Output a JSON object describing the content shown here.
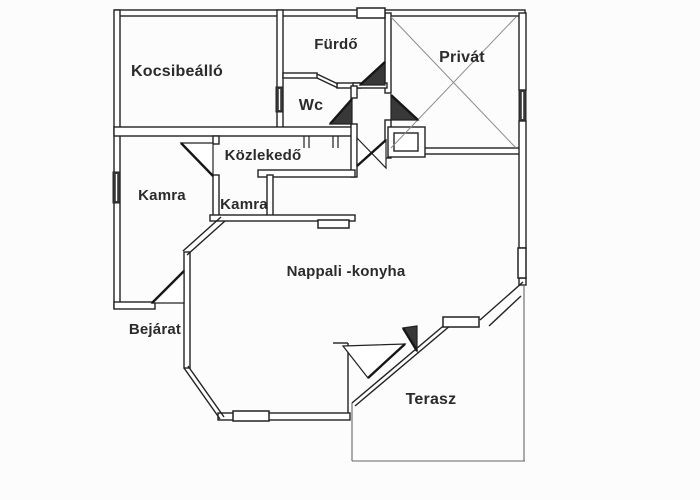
{
  "canvas": {
    "width": 700,
    "height": 500,
    "background": "#fcfcfc",
    "wall_fill": "#ffffff",
    "wall_stroke": "#222222",
    "dark_fill": "#383838",
    "thin_color": "#666666",
    "diag_color": "#8c8c8c",
    "text_color": "#2b2b2b"
  },
  "plan": {
    "labels": [
      {
        "id": "kocsibeallo",
        "text": "Kocsibeálló",
        "x": 177,
        "y": 72,
        "size": 16
      },
      {
        "id": "furdo",
        "text": "Fürdő",
        "x": 336,
        "y": 45,
        "size": 15
      },
      {
        "id": "wc",
        "text": "Wc",
        "x": 311,
        "y": 106,
        "size": 16
      },
      {
        "id": "privat",
        "text": "Privát",
        "x": 462,
        "y": 58,
        "size": 16
      },
      {
        "id": "kamra-nagy",
        "text": "Kamra",
        "x": 162,
        "y": 196,
        "size": 15
      },
      {
        "id": "kozlekedo",
        "text": "Közlekedő",
        "x": 263,
        "y": 156,
        "size": 15
      },
      {
        "id": "kamra-kicsi",
        "text": "Kamra",
        "x": 244,
        "y": 205,
        "size": 15
      },
      {
        "id": "nappali",
        "text": "Nappali -konyha",
        "x": 346,
        "y": 272,
        "size": 15
      },
      {
        "id": "bejarat",
        "text": "Bejárat",
        "x": 155,
        "y": 330,
        "size": 15
      },
      {
        "id": "terasz",
        "text": "Terasz",
        "x": 431,
        "y": 400,
        "size": 16
      }
    ],
    "walls": [
      {
        "n": "top-wall",
        "r": [
          115,
          10,
          410,
          6
        ]
      },
      {
        "n": "left-wall",
        "r": [
          114,
          10,
          6,
          298
        ]
      },
      {
        "n": "carport-right-wall",
        "r": [
          277,
          10,
          6,
          122
        ]
      },
      {
        "n": "main-horizontal-wall",
        "r": [
          114,
          127,
          242,
          9
        ]
      },
      {
        "n": "bath-private-wall",
        "r": [
          385,
          13,
          6,
          80
        ]
      },
      {
        "n": "private-left-wall",
        "r": [
          385,
          120,
          6,
          38
        ]
      },
      {
        "n": "private-bottom-wall",
        "r": [
          423,
          148,
          98,
          6
        ]
      },
      {
        "n": "right-wall-top",
        "r": [
          519,
          13,
          7,
          77
        ]
      },
      {
        "n": "right-wall-mid",
        "r": [
          519,
          121,
          7,
          127
        ]
      },
      {
        "n": "right-wall-stub",
        "r": [
          519,
          278,
          7,
          7
        ]
      },
      {
        "n": "bath-bottom-wall-a",
        "r": [
          283,
          73,
          34,
          5
        ]
      },
      {
        "n": "bath-bottom-wall-b",
        "r": [
          337,
          83,
          24,
          5
        ]
      },
      {
        "n": "hall-top-wall",
        "r": [
          353,
          83,
          34,
          5
        ]
      },
      {
        "n": "wc-right-wall-a",
        "r": [
          351,
          86,
          6,
          12
        ]
      },
      {
        "n": "wc-right-wall-b",
        "r": [
          351,
          124,
          6,
          53
        ]
      },
      {
        "n": "hallway-bottom-wall",
        "r": [
          258,
          170,
          97,
          7
        ]
      },
      {
        "n": "pantry2-left-wall-stub",
        "r": [
          213,
          136,
          6,
          8
        ]
      },
      {
        "n": "pantry2-left-wall",
        "r": [
          213,
          175,
          6,
          41
        ]
      },
      {
        "n": "closet-divider-wall",
        "r": [
          267,
          175,
          6,
          41
        ]
      },
      {
        "n": "closet-bottom-wall",
        "r": [
          210,
          215,
          145,
          6
        ]
      },
      {
        "n": "living-left-wall",
        "r": [
          184,
          252,
          6,
          116
        ]
      },
      {
        "n": "pantry-bottom-wall",
        "r": [
          114,
          302,
          41,
          7
        ]
      },
      {
        "n": "living-bottom-wall",
        "r": [
          218,
          413,
          132,
          7
        ]
      },
      {
        "n": "private-nook-outer",
        "r": [
          388,
          127,
          37,
          30
        ]
      },
      {
        "n": "private-nook-inner",
        "r": [
          394,
          133,
          24,
          18
        ]
      }
    ],
    "lines": [
      {
        "n": "bay-upper-chamfer-outer",
        "p": [
          183,
          251,
          221,
          217
        ],
        "w": 1.4
      },
      {
        "n": "bay-upper-chamfer-inner",
        "p": [
          187,
          255,
          225,
          221
        ],
        "w": 1.4
      },
      {
        "n": "bay-lower-chamfer-outer",
        "p": [
          184,
          368,
          220,
          419
        ],
        "w": 1.4
      },
      {
        "n": "bay-lower-chamfer-inner",
        "p": [
          188,
          366,
          224,
          417
        ],
        "w": 1.4
      },
      {
        "n": "terrace-diagonal-outer",
        "p": [
          352,
          403,
          448,
          322
        ],
        "w": 1.4
      },
      {
        "n": "terrace-diagonal-inner",
        "p": [
          355,
          406,
          451,
          325
        ],
        "w": 1.4
      },
      {
        "n": "terrace-ne-chamfer-outer",
        "p": [
          480,
          320,
          523,
          282
        ],
        "w": 1.4
      },
      {
        "n": "terrace-ne-chamfer-inner",
        "p": [
          489,
          326,
          521,
          296
        ],
        "w": 1.4
      },
      {
        "n": "kitchen-step-h",
        "p": [
          333,
          343,
          348,
          343
        ],
        "w": 1.4
      },
      {
        "n": "kitchen-step-v",
        "p": [
          348,
          343,
          348,
          413
        ],
        "w": 1.4
      },
      {
        "n": "bath-step-diag-a",
        "p": [
          317,
          74,
          338,
          84
        ],
        "w": 1.3
      },
      {
        "n": "bath-step-diag-b",
        "p": [
          317,
          78,
          338,
          88
        ],
        "w": 1.3
      },
      {
        "n": "terrace-edge-left",
        "p": [
          352,
          403,
          352,
          461
        ],
        "w": 1.1,
        "c": "#666666"
      },
      {
        "n": "terrace-edge-bottom",
        "p": [
          352,
          461,
          525,
          461
        ],
        "w": 1.1,
        "c": "#666666"
      },
      {
        "n": "terrace-edge-right",
        "p": [
          524,
          284,
          524,
          461
        ],
        "w": 1.1,
        "c": "#666666"
      },
      {
        "n": "private-x-diagonal-1",
        "p": [
          391,
          17,
          516,
          148
        ],
        "w": 1,
        "c": "#8c8c8c"
      },
      {
        "n": "private-x-diagonal-2",
        "p": [
          516,
          17,
          391,
          148
        ],
        "w": 1,
        "c": "#8c8c8c"
      },
      {
        "n": "door-jamb-1",
        "p": [
          304,
          136,
          304,
          148
        ],
        "w": 1.2
      },
      {
        "n": "door-jamb-2",
        "p": [
          309,
          136,
          309,
          148
        ],
        "w": 1.2
      },
      {
        "n": "door-jamb-3",
        "p": [
          333,
          136,
          333,
          148
        ],
        "w": 1.2
      },
      {
        "n": "door-jamb-4",
        "p": [
          338,
          136,
          338,
          148
        ],
        "w": 1.2
      }
    ],
    "windows": [
      {
        "n": "top-window",
        "r": [
          357,
          8,
          28,
          10
        ]
      },
      {
        "n": "living-bottom-window",
        "r": [
          233,
          411,
          36,
          10
        ]
      },
      {
        "n": "terrace-window",
        "r": [
          443,
          317,
          36,
          10
        ]
      },
      {
        "n": "right-mid-window",
        "r": [
          518,
          248,
          8,
          30
        ]
      },
      {
        "n": "kitchen-pass",
        "r": [
          318,
          220,
          31,
          8
        ]
      },
      {
        "n": "left-wall-window",
        "r": [
          113,
          172,
          7,
          31
        ],
        "dark": true
      },
      {
        "n": "wc-carport-window",
        "r": [
          276,
          87,
          7,
          25
        ],
        "dark": true
      },
      {
        "n": "private-right-window",
        "r": [
          519,
          90,
          7,
          31
        ],
        "dark": true
      }
    ],
    "doors": [
      {
        "n": "pantry-door",
        "pts": [
          [
            181,
            143
          ],
          [
            213,
            143
          ],
          [
            213,
            176
          ]
        ],
        "leaf": [
          181,
          143,
          213,
          176
        ]
      },
      {
        "n": "entrance-door",
        "pts": [
          [
            152,
            303
          ],
          [
            184,
            303
          ],
          [
            184,
            271
          ]
        ],
        "leaf": [
          152,
          303,
          184,
          271
        ]
      },
      {
        "n": "bath-door",
        "pts": [
          [
            360,
            85
          ],
          [
            385,
            85
          ],
          [
            385,
            62
          ]
        ],
        "leaf": [
          360,
          85,
          385,
          62
        ],
        "dark": true
      },
      {
        "n": "wc-door",
        "pts": [
          [
            330,
            124
          ],
          [
            352,
            124
          ],
          [
            352,
            99
          ]
        ],
        "leaf": [
          330,
          124,
          352,
          99
        ],
        "dark": true
      },
      {
        "n": "hall-door",
        "pts": [
          [
            357,
            138
          ],
          [
            386,
            168
          ],
          [
            386,
            140
          ],
          [
            357,
            166
          ]
        ],
        "leaf": [
          357,
          166,
          386,
          140
        ]
      },
      {
        "n": "private-door",
        "pts": [
          [
            391,
            95
          ],
          [
            418,
            120
          ],
          [
            391,
            120
          ]
        ],
        "leaf": [
          391,
          95,
          418,
          120
        ],
        "dark": true
      },
      {
        "n": "terrace-door-left",
        "pts": [
          [
            343,
            346
          ],
          [
            405,
            344
          ],
          [
            368,
            378
          ]
        ],
        "leaf": [
          405,
          344,
          368,
          378
        ]
      },
      {
        "n": "terrace-door-right",
        "pts": [
          [
            417,
            326
          ],
          [
            417,
            351
          ],
          [
            403,
            328
          ]
        ],
        "leaf": [
          417,
          351,
          403,
          328
        ],
        "dark": true
      }
    ]
  }
}
